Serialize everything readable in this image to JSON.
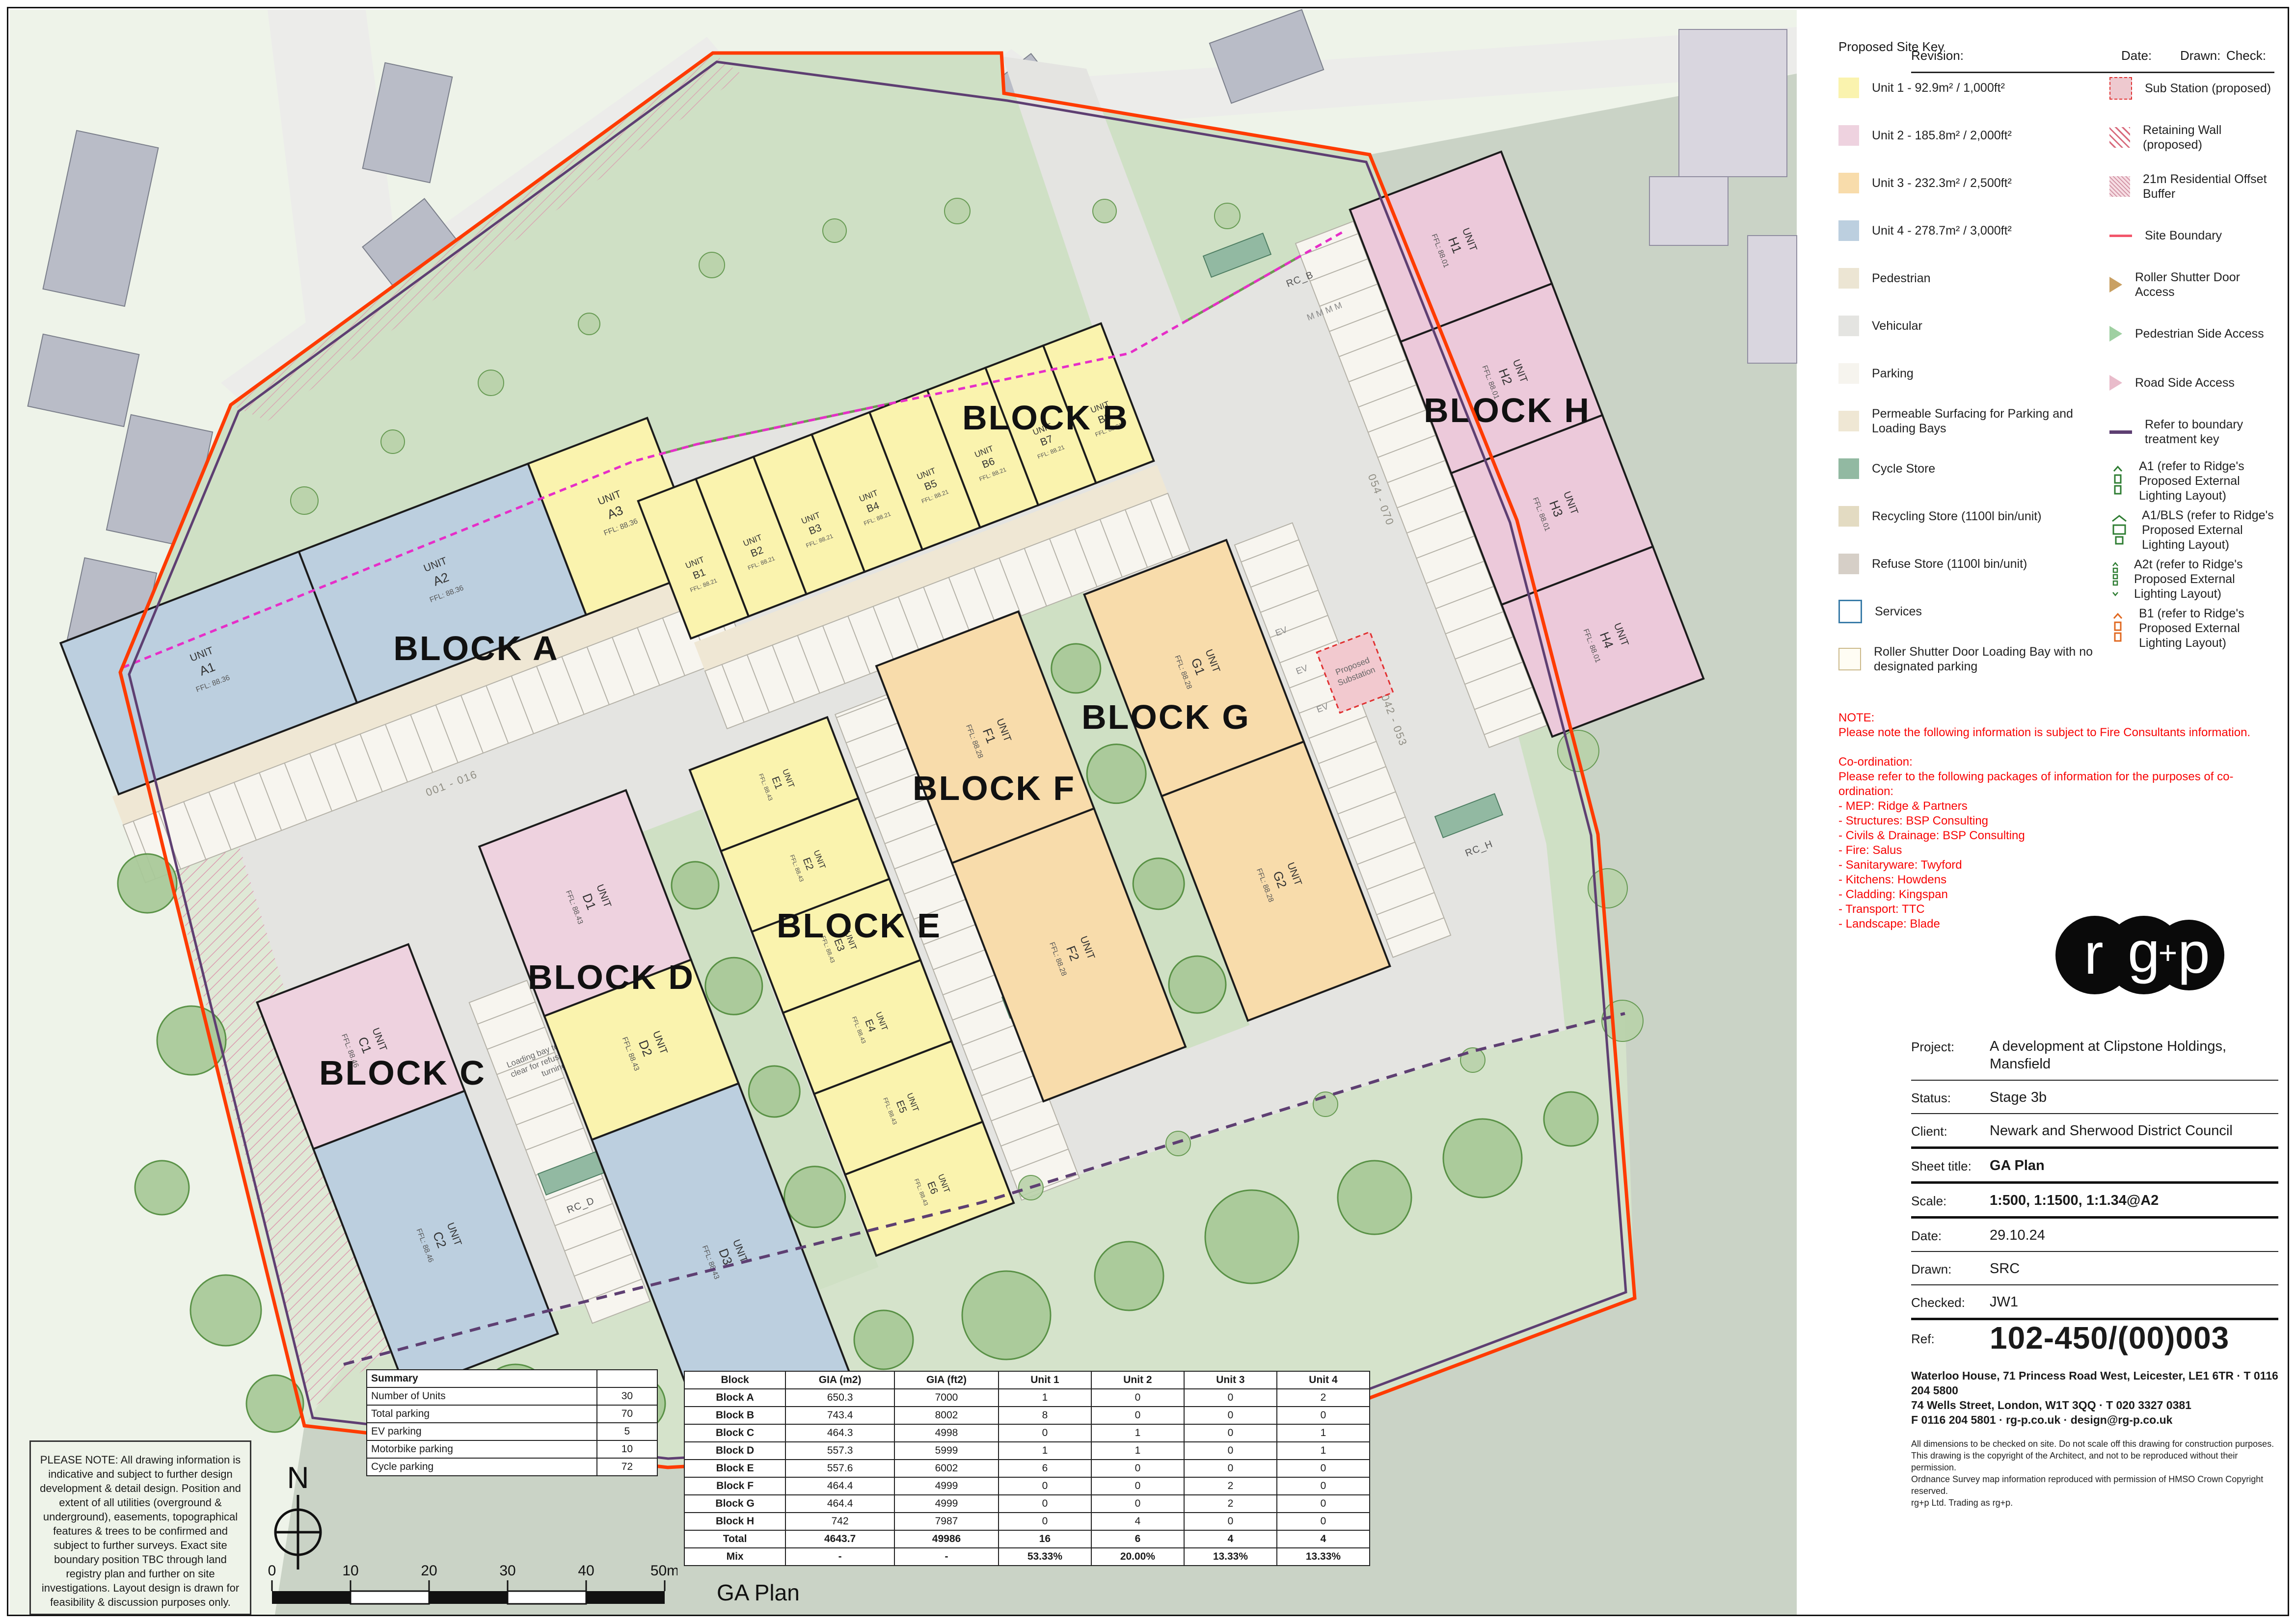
{
  "header": {
    "revision": "Revision:",
    "date": "Date:",
    "drawn": "Drawn:",
    "check": "Check:"
  },
  "legend": {
    "title": "Proposed Site Key",
    "left": [
      {
        "icon": "swatch",
        "color": "#faf3ae",
        "label": "Unit 1 - 92.9m² / 1,000ft²"
      },
      {
        "icon": "swatch",
        "color": "#eed2df",
        "label": "Unit 2 - 185.8m² / 2,000ft²"
      },
      {
        "icon": "swatch",
        "color": "#f8dcab",
        "label": "Unit 3 - 232.3m² / 2,500ft²"
      },
      {
        "icon": "swatch",
        "color": "#bccfdf",
        "label": "Unit 4 - 278.7m² / 3,000ft²"
      },
      {
        "icon": "swatch",
        "color": "#ece5d3",
        "label": "Pedestrian"
      },
      {
        "icon": "swatch",
        "color": "#e4e4e1",
        "label": "Vehicular"
      },
      {
        "icon": "swatch",
        "color": "#f6f4ee",
        "label": "Parking"
      },
      {
        "icon": "swatch",
        "color": "#efe7d4",
        "label": "Permeable Surfacing for Parking and Loading Bays"
      },
      {
        "icon": "swatch",
        "color": "#92b9a2",
        "label": "Cycle Store"
      },
      {
        "icon": "swatch",
        "color": "#e3dbc2",
        "label": "Recycling Store (1100l bin/unit)"
      },
      {
        "icon": "swatch",
        "color": "#d6cfc7",
        "label": "Refuse Store (1100l bin/unit)"
      },
      {
        "icon": "services",
        "label": "Services"
      },
      {
        "icon": "roller-bay",
        "label": "Roller Shutter Door Loading Bay with no designated parking"
      }
    ],
    "right": [
      {
        "icon": "substation",
        "label": "Sub Station (proposed)"
      },
      {
        "icon": "retaining",
        "label": "Retaining Wall (proposed)"
      },
      {
        "icon": "buffer",
        "label": "21m Residential Offset Buffer"
      },
      {
        "icon": "boundary-line",
        "label": "Site Boundary"
      },
      {
        "icon": "arrow-tan",
        "label": "Roller Shutter Door Access"
      },
      {
        "icon": "arrow-green",
        "label": "Pedestrian Side Access"
      },
      {
        "icon": "arrow-pink",
        "label": "Road Side Access"
      },
      {
        "icon": "treatment-line",
        "label": "Refer to boundary treatment key"
      },
      {
        "icon": "light-a1",
        "label": "A1 (refer to Ridge's Proposed External Lighting Layout)"
      },
      {
        "icon": "light-a1bls",
        "label": "A1/BLS (refer to Ridge's Proposed External Lighting Layout)"
      },
      {
        "icon": "light-a2t",
        "label": "A2t (refer to Ridge's Proposed External Lighting Layout)"
      },
      {
        "icon": "light-b1",
        "label": "B1 (refer to Ridge's Proposed External Lighting Layout)"
      }
    ]
  },
  "note": {
    "lines": [
      "NOTE:",
      "Please note the following information is subject to Fire Consultants information.",
      "",
      "Co-ordination:",
      "Please refer to the following packages of information for the purposes of co-ordination:",
      "- MEP: Ridge & Partners",
      "- Structures: BSP Consulting",
      "- Civils & Drainage: BSP Consulting",
      "- Fire: Salus",
      "- Sanitaryware: Twyford",
      "- Kitchens: Howdens",
      "- Cladding: Kingspan",
      "- Transport: TTC",
      "- Landscape: Blade"
    ]
  },
  "logo": {
    "l1": "r",
    "l2": "g",
    "l3": "+",
    "l4": "p"
  },
  "title_block": {
    "rows": [
      {
        "label": "Project:",
        "value": "A development at Clipstone Holdings, Mansfield",
        "sep": "thin",
        "cls": ""
      },
      {
        "label": "Status:",
        "value": "Stage 3b",
        "sep": "thin",
        "cls": ""
      },
      {
        "label": "Client:",
        "value": "Newark and Sherwood District Council",
        "sep": "thick",
        "cls": ""
      },
      {
        "label": "Sheet title:",
        "value": "GA Plan",
        "sep": "thick",
        "cls": "bold"
      },
      {
        "label": "Scale:",
        "value": "1:500, 1:1500, 1:1.34@A2",
        "sep": "thick",
        "cls": "bold"
      },
      {
        "label": "Date:",
        "value": "29.10.24",
        "sep": "thin",
        "cls": ""
      },
      {
        "label": "Drawn:",
        "value": "SRC",
        "sep": "thin",
        "cls": ""
      },
      {
        "label": "Checked:",
        "value": "JW1",
        "sep": "thick",
        "cls": ""
      },
      {
        "label": "Ref:",
        "value": "102-450/(00)003",
        "sep": "none",
        "cls": "ref"
      }
    ],
    "address": [
      "Waterloo House, 71 Princess Road West, Leicester, LE1 6TR · T 0116 204 5800",
      "74 Wells Street, London, W1T 3QQ · T 020 3327 0381",
      "F 0116 204 5801 · rg-p.co.uk · design@rg-p.co.uk"
    ],
    "disclaimer": [
      "All dimensions to be checked on site. Do not scale off this drawing for construction purposes.",
      "This drawing is the copyright of the Architect, and not to be reproduced without their permission.",
      "Ordnance Survey map information reproduced with permission of HMSO Crown Copyright reserved.",
      "rg+p Ltd. Trading as rg+p."
    ]
  },
  "please_note": "PLEASE NOTE: All drawing information is indicative and subject to further design development & detail design. Position and extent of all utilities (overground & underground), easements, topographical features & trees to be confirmed and subject to further surveys. Exact site boundary position TBC through land registry plan and further on site investigations. Layout design is drawn for feasibility & discussion purposes only.",
  "north_label": "N",
  "scale_bar": {
    "labels": [
      "0",
      "10",
      "20",
      "30",
      "40",
      "50m"
    ]
  },
  "ga_plan_label": "GA Plan",
  "summary_table": {
    "header": "Summary",
    "rows": [
      [
        "Number of Units",
        "30"
      ],
      [
        "Total parking",
        "70"
      ],
      [
        "EV parking",
        "5"
      ],
      [
        "Motorbike parking",
        "10"
      ],
      [
        "Cycle parking",
        "72"
      ]
    ]
  },
  "block_table": {
    "headers": [
      "Block",
      "GIA (m2)",
      "GIA (ft2)",
      "Unit 1",
      "Unit 2",
      "Unit 3",
      "Unit 4"
    ],
    "rows": [
      [
        "Block A",
        "650.3",
        "7000",
        "1",
        "0",
        "0",
        "2"
      ],
      [
        "Block B",
        "743.4",
        "8002",
        "8",
        "0",
        "0",
        "0"
      ],
      [
        "Block C",
        "464.3",
        "4998",
        "0",
        "1",
        "0",
        "1"
      ],
      [
        "Block D",
        "557.3",
        "5999",
        "1",
        "1",
        "0",
        "1"
      ],
      [
        "Block E",
        "557.6",
        "6002",
        "6",
        "0",
        "0",
        "0"
      ],
      [
        "Block F",
        "464.4",
        "4999",
        "0",
        "0",
        "2",
        "0"
      ],
      [
        "Block G",
        "464.4",
        "4999",
        "0",
        "0",
        "2",
        "0"
      ],
      [
        "Block H",
        "742",
        "7987",
        "0",
        "4",
        "0",
        "0"
      ]
    ],
    "total": [
      "Total",
      "4643.7",
      "49986",
      "16",
      "6",
      "4",
      "4"
    ],
    "mix": [
      "Mix",
      "-",
      "-",
      "53.33%",
      "20.00%",
      "13.33%",
      "13.33%"
    ]
  },
  "plan": {
    "unit_word": "UNIT",
    "blocks": [
      {
        "label": "BLOCK A",
        "units": [
          {
            "id": "A1",
            "ffl": "FFL: 88.36"
          },
          {
            "id": "A2",
            "ffl": "FFL: 88.36"
          },
          {
            "id": "A3",
            "ffl": "FFL: 88.36"
          }
        ]
      },
      {
        "label": "BLOCK B",
        "units": [
          {
            "id": "B1",
            "ffl": "FFL: 88.21"
          },
          {
            "id": "B2",
            "ffl": "FFL: 88.21"
          },
          {
            "id": "B3",
            "ffl": "FFL: 88.21"
          },
          {
            "id": "B4",
            "ffl": "FFL: 88.21"
          },
          {
            "id": "B5",
            "ffl": "FFL: 88.21"
          },
          {
            "id": "B6",
            "ffl": "FFL: 88.21"
          },
          {
            "id": "B7",
            "ffl": "FFL: 88.21"
          },
          {
            "id": "B8",
            "ffl": "FFL: 88.21"
          }
        ]
      },
      {
        "label": "BLOCK C",
        "units": [
          {
            "id": "C1",
            "ffl": "FFL: 88.46"
          },
          {
            "id": "C2",
            "ffl": "FFL: 88.46"
          }
        ]
      },
      {
        "label": "BLOCK D",
        "units": [
          {
            "id": "D1",
            "ffl": "FFL: 88.43"
          },
          {
            "id": "D2",
            "ffl": "FFL: 88.43"
          },
          {
            "id": "D3",
            "ffl": "FFL: 88.43"
          }
        ]
      },
      {
        "label": "BLOCK E",
        "units": [
          {
            "id": "E1",
            "ffl": "FFL: 88.43"
          },
          {
            "id": "E2",
            "ffl": "FFL: 88.43"
          },
          {
            "id": "E3",
            "ffl": "FFL: 88.43"
          },
          {
            "id": "E4",
            "ffl": "FFL: 88.43"
          },
          {
            "id": "E5",
            "ffl": "FFL: 88.43"
          },
          {
            "id": "E6",
            "ffl": "FFL: 88.43"
          }
        ]
      },
      {
        "label": "BLOCK F",
        "units": [
          {
            "id": "F1",
            "ffl": "FFL: 88.28"
          },
          {
            "id": "F2",
            "ffl": "FFL: 88.28"
          }
        ]
      },
      {
        "label": "BLOCK G",
        "units": [
          {
            "id": "G1",
            "ffl": "FFL: 88.28"
          },
          {
            "id": "G2",
            "ffl": "FFL: 88.28"
          }
        ]
      },
      {
        "label": "BLOCK H",
        "units": [
          {
            "id": "H1",
            "ffl": "FFL: 88.01"
          },
          {
            "id": "H2",
            "ffl": "FFL: 88.01"
          },
          {
            "id": "H3",
            "ffl": "FFL: 88.01"
          },
          {
            "id": "H4",
            "ffl": "FFL: 88.01"
          }
        ]
      }
    ],
    "annotations": {
      "substation_1": "Proposed",
      "substation_2": "Substation",
      "bus": "Bus",
      "cycle": "12no. CYCLE",
      "rc_b": "RC_B",
      "rc_d": "RC_D",
      "rc_e": "RC_E",
      "rc_fg": "RC_FG",
      "rc_h": "RC_H",
      "ev": "EV",
      "m": "M M M M",
      "loading_1": "Loading bay to be kept",
      "loading_2": "clear for refuse vehicle",
      "loading_3": "turning",
      "turning_1": "16.5m articulated",
      "turning_2": "vehicle turning circle",
      "turning_3": "(12.5m radius)",
      "turning_4": "Area to be kept clear",
      "turning_5": "of vehicles through",
      "turning_6": "signage and",
      "turning_7": "management for",
      "turning_8": "turning use only.",
      "bays_a": "001 - 016",
      "bays_b": "017 - 025",
      "bays_cd": "026 - 033",
      "bays_e": "034 - 041",
      "bays_g": "042 - 053",
      "bays_h": "054 - 070"
    },
    "colors": {
      "unit1": "#faf3ae",
      "unit2": "#eed2df",
      "unit3": "#f8dcab",
      "unit4": "#bccfdf",
      "site_boundary": "#fe3b00",
      "boundary_treatment": "#5e3f72",
      "retaining_line": "#e62ec8",
      "cycle_store": "#92b9a2",
      "road": "#e4e4e1",
      "green": "#cfe0c5"
    }
  }
}
